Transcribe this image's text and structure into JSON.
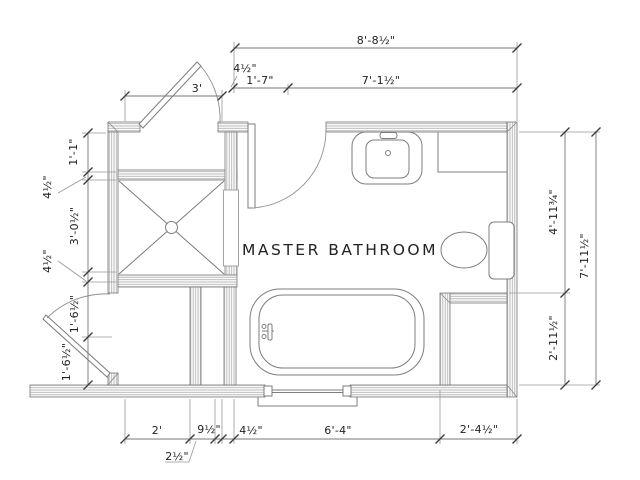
{
  "title": {
    "room_label": "MASTER BATHROOM"
  },
  "dimensions": {
    "top_overall": "8'-8½\"",
    "top_wall": "4½\"",
    "top_left_seg": "1'-7\"",
    "top_right_seg": "7'-1½\"",
    "door_top": "3'",
    "left_1": "1'-1\"",
    "left_2": "4½\"",
    "left_3": "3'-0½\"",
    "left_4": "4½\"",
    "left_5": "1'-6½\"",
    "left_6": "1'-6½\"",
    "right_upper": "4'-11¾\"",
    "right_lower": "2'-11½\"",
    "right_overall": "7'-11½\"",
    "bottom_1": "2'",
    "bottom_2": "9½\"",
    "bottom_3": "2½\"",
    "bottom_4": "4½\"",
    "bottom_5": "6'-4\"",
    "bottom_6": "2'-4½\""
  },
  "colors": {
    "background": "#ffffff",
    "wall_hatch": "#b2b2b2",
    "drawing_line": "#7d7d7d",
    "dimension_line": "#777777",
    "text": "#222222"
  }
}
